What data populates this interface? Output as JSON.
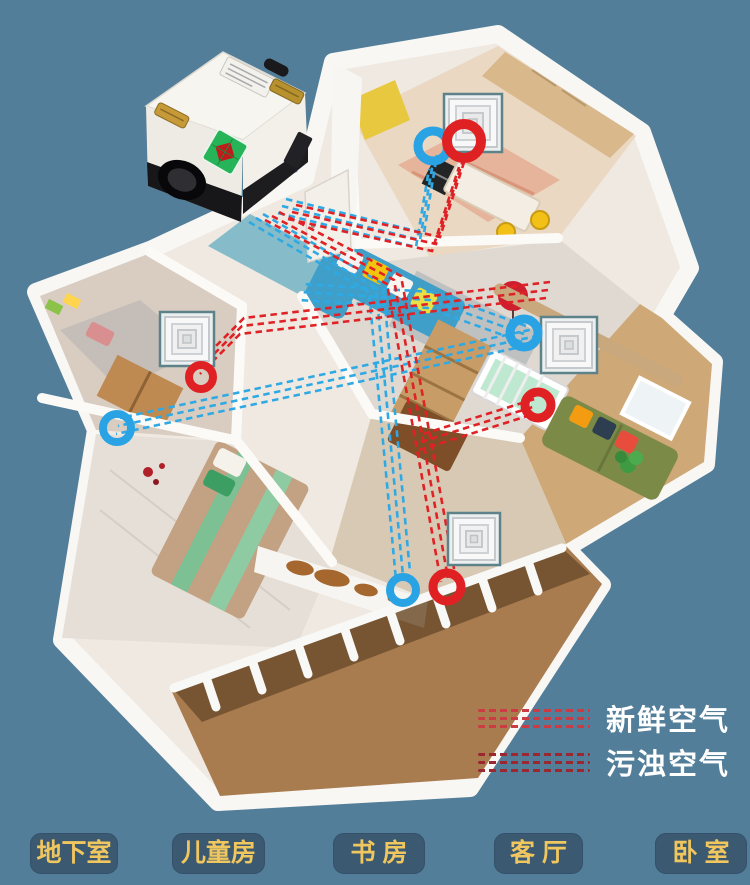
{
  "scene": {
    "description": "3D isometric apartment cutaway with central fresh-air ventilation unit, dashed duct runs and ceiling diffusers",
    "background_color": "#527e99"
  },
  "legend": {
    "text_color": "#ffffff",
    "items": [
      {
        "id": "fresh-air",
        "label": "新鲜空气",
        "color": "#cc3a43",
        "icon": "triple-dashed-line-icon"
      },
      {
        "id": "polluted-air",
        "label": "污浊空气",
        "color": "#9c2731",
        "icon": "triple-dashed-line-icon"
      }
    ]
  },
  "room_labels": [
    {
      "label": "地下室"
    },
    {
      "label": "儿童房"
    },
    {
      "label": "书 房"
    },
    {
      "label": "客 厅"
    },
    {
      "label": "卧 室"
    }
  ],
  "room_label_style": {
    "background": "#3b5971",
    "text_color": "#f0c65f"
  },
  "ducts": {
    "blue_duct_color": "#2fa9e4",
    "red_duct_color": "#e02125",
    "style": "triple dashed lines"
  },
  "markers": {
    "blue_ring_color": "#29a3e3",
    "red_ring_color": "#e02124",
    "ceiling_diffuser_count": 4,
    "blue_ring_count": 4,
    "red_ring_count": 4
  },
  "machine": {
    "name": "fresh-air-ventilation-unit",
    "body_color": "#f5f3ee",
    "base_color": "#17171a",
    "label_color": "#27b357"
  }
}
